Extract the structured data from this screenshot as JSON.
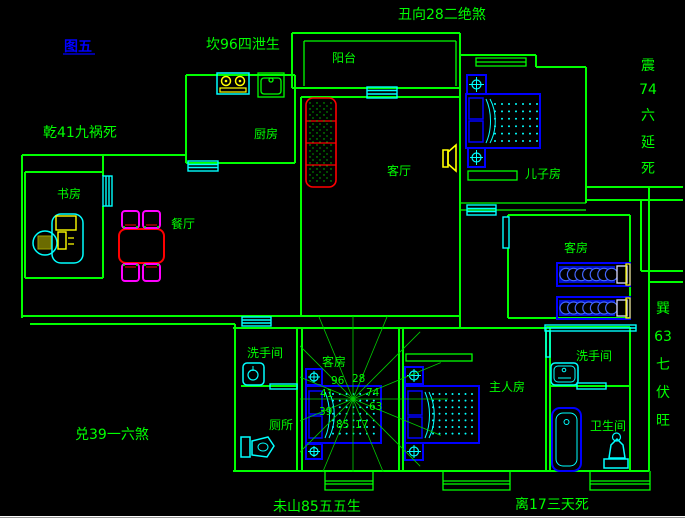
{
  "figure_label": "图五",
  "colors": {
    "background": "#000000",
    "wall_green": "#00ff00",
    "window_cyan": "#00ffff",
    "furniture_blue": "#0000ff",
    "table_red": "#ff0000",
    "chair_magenta": "#ff00ff",
    "accent_yellow": "#ffff00",
    "figure_label_blue": "#0000ff",
    "page_edge_white": "#ffffff"
  },
  "annotations": {
    "top_left": "坎96四泄生",
    "top_center": "丑向28二绝煞",
    "left_upper": "乾41九祸死",
    "left_lower": "兑39一六煞",
    "bottom_left": "未山85五五生",
    "bottom_right": "离17三天死",
    "right_upper_vertical": {
      "text": "震74六延死",
      "lines": [
        "震",
        "74",
        "六",
        "延",
        "死"
      ]
    },
    "right_lower_vertical": {
      "text": "巽63七伏旺",
      "lines": [
        "巽",
        "63",
        "七",
        "伏",
        "旺"
      ]
    }
  },
  "rooms": {
    "balcony": "阳台",
    "kitchen": "厨房",
    "living_room": "客厅",
    "dining_room": "餐厅",
    "study": "书房",
    "sons_room": "儿子房",
    "guest_room_right": "客房",
    "guest_room_center": "客房",
    "washroom_left": "洗手间",
    "toilet_left": "厕所",
    "master_room": "主人房",
    "washroom_right": "洗手间",
    "bathroom_right": "卫生间"
  },
  "compass_numbers": [
    "96",
    "28",
    "41",
    "74",
    "39",
    "63",
    "85",
    "17"
  ]
}
